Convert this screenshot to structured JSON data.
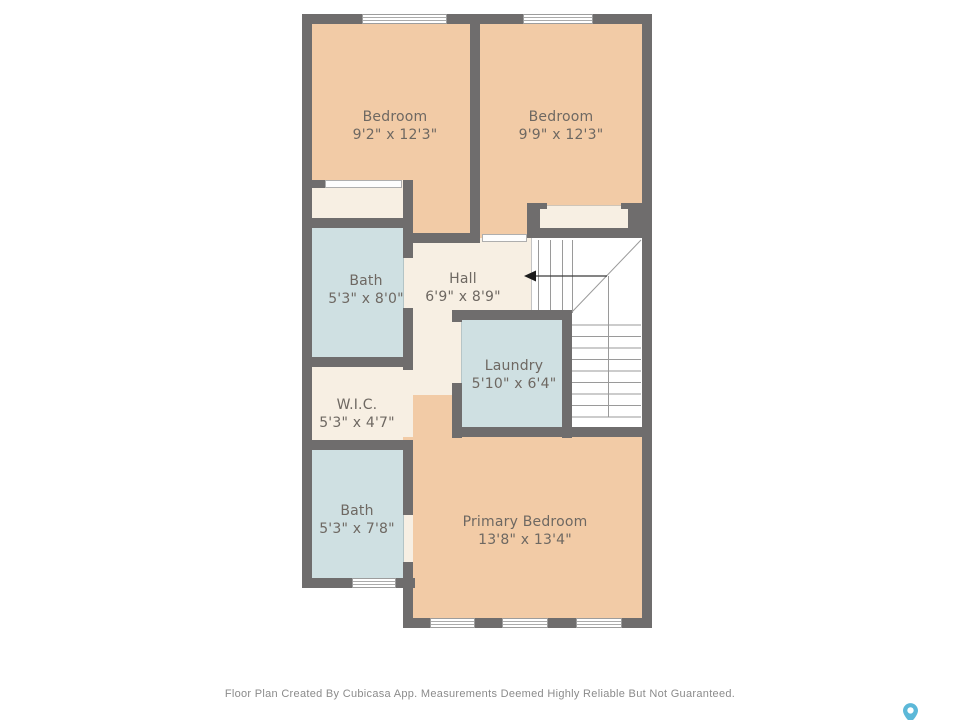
{
  "plan": {
    "rooms": [
      {
        "id": "bedroom-1",
        "label": "Bedroom",
        "dims": "9'2\" x 12'3\""
      },
      {
        "id": "bedroom-2",
        "label": "Bedroom",
        "dims": "9'9\" x 12'3\""
      },
      {
        "id": "bath-1",
        "label": "Bath",
        "dims": "5'3\" x 8'0\""
      },
      {
        "id": "hall",
        "label": "Hall",
        "dims": "6'9\" x 8'9\""
      },
      {
        "id": "laundry",
        "label": "Laundry",
        "dims": "5'10\" x 6'4\""
      },
      {
        "id": "wic",
        "label": "W.I.C.",
        "dims": "5'3\" x 4'7\""
      },
      {
        "id": "bath-2",
        "label": "Bath",
        "dims": "5'3\" x 7'8\""
      },
      {
        "id": "primary-bedroom",
        "label": "Primary Bedroom",
        "dims": "13'8\" x 13'4\""
      }
    ],
    "stairs": {
      "direction_icon": "left-arrow-icon"
    }
  },
  "footer": {
    "disclaimer": "Floor Plan Created By Cubicasa App. Measurements Deemed Highly Reliable But Not Guaranteed."
  },
  "branding": {
    "logo_icon": "map-pin-icon"
  },
  "colors": {
    "background": "#ffffff",
    "wall": "#6f6d6d",
    "room_warm": "#f2cba6",
    "room_neutral": "#f7efe3",
    "room_wet": "#cfe0e2",
    "stairs": "#ffffff",
    "line": "#9a9a9a",
    "label_text": "#6e6862",
    "footer_text": "#8b8b8b",
    "arrow": "#1c1c1c",
    "logo": "#5cb8d8"
  }
}
